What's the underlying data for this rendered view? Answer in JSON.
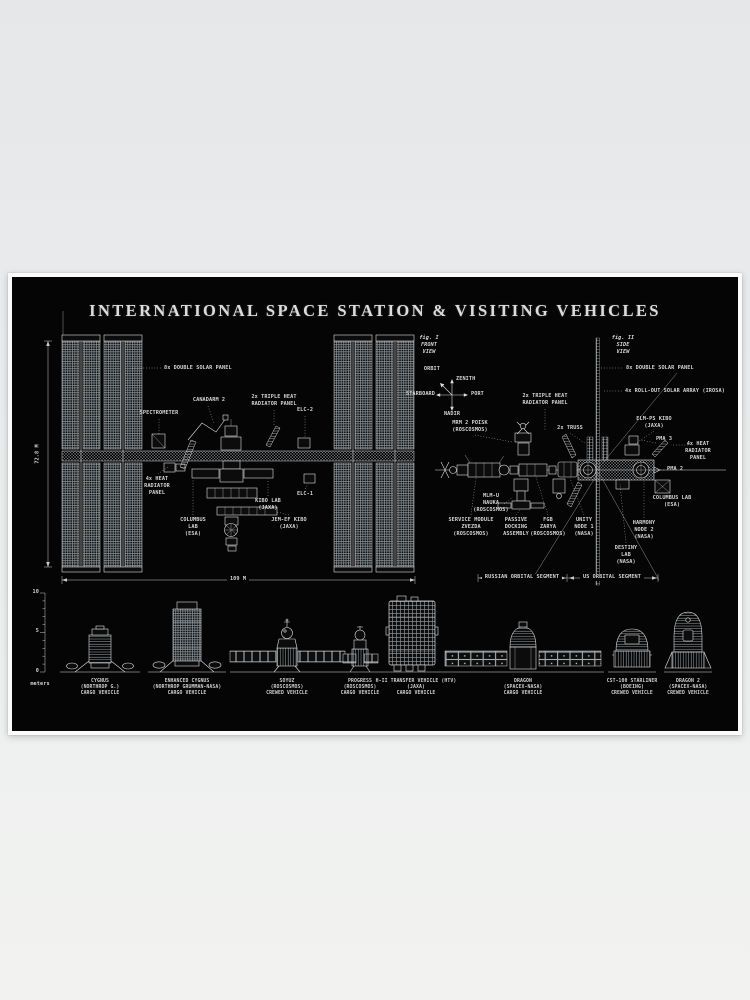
{
  "poster": {
    "title": "INTERNATIONAL SPACE STATION & VISITING VEHICLES",
    "front_view": {
      "fig_caption": "fig. I\nFRONT\nVIEW",
      "labels": {
        "double_solar": "8x DOUBLE SOLAR PANEL",
        "spectrometer": "SPECTROMETER",
        "canadarm": "CANADARM 2",
        "triple_radiator": "2x TRIPLE HEAT\nRADIATOR PANEL",
        "elc2": "ELC-2",
        "heat_radiator": "4x HEAT\nRADIATOR\nPANEL",
        "columbus": "COLUMBUS\nLAB\n(ESA)",
        "kibo": "KIBO LAB\n(JAXA)",
        "jem_ef": "JEM-EF KIBO\n(JAXA)",
        "elc1": "ELC-1"
      },
      "dim_height": "72.8 M",
      "dim_width": "109 M"
    },
    "compass": {
      "orbit": "ORBIT",
      "zenith": "ZENITH",
      "starboard": "STARBOARD",
      "port": "PORT",
      "nadir": "NADIR"
    },
    "side_view": {
      "fig_caption": "fig. II\nSIDE\nVIEW",
      "labels": {
        "double_solar": "8x DOUBLE SOLAR PANEL",
        "irosa": "4x ROLL-OUT SOLAR ARRAY (IROSA)",
        "triple_radiator": "2x TRIPLE HEAT\nRADIATOR PANEL",
        "mrm2": "MRM 2 POISK\n(ROSCOSMOS)",
        "truss": "2x TRUSS",
        "elm_ps": "ELM-PS KIBO\n(JAXA)",
        "pma3": "PMA 3",
        "heat_radiator": "4x HEAT\nRADIATOR\nPANEL",
        "pma2": "PMA 2",
        "columbus": "COLUMBUS LAB\n(ESA)",
        "mlm": "MLM-U\nNAUKA\n(ROSCOSMOS)",
        "zvezda": "SERVICE MODULE\nZVEZDA\n(ROSCOSMOS)",
        "docking": "PASSIVE\nDOCKING\nASSEMBLY",
        "zarya": "FGB\nZARYA\n(ROSCOSMOS)",
        "unity": "UNITY\nNODE 1\n(NASA)",
        "harmony": "HARMONY\nNODE 2\n(NASA)",
        "destiny": "DESTINY\nLAB\n(NASA)"
      },
      "segment_left": "RUSSIAN ORBITAL SEGMENT",
      "segment_right": "US ORBITAL SEGMENT"
    },
    "scale": {
      "ticks": [
        "10",
        "5",
        "0"
      ],
      "unit": "meters"
    },
    "vehicles": [
      {
        "label": "CYGNUS\n(NORTHROP G.)\nCARGO VEHICLE"
      },
      {
        "label": "ENHANCED CYGNUS\n(NORTHROP GRUMMAN-NASA)\nCARGO VEHICLE"
      },
      {
        "label": "SOYUZ\n(ROSCOSMOS)\nCREWED VEHICLE"
      },
      {
        "label": "PROGRESS\n(ROSCOSMOS)\nCARGO VEHICLE"
      },
      {
        "label": "H-II TRANSFER VEHICLE (HTV)\n(JAXA)\nCARGO VEHICLE"
      },
      {
        "label": "DRAGON\n(SPACEX-NASA)\nCARGO VEHICLE"
      },
      {
        "label": "CST-100 STARLINER\n(BOEING)\nCREWED VEHICLE"
      },
      {
        "label": "DRAGON 2\n(SPACEX-NASA)\nCREWED VEHICLE"
      }
    ],
    "colors": {
      "wall": "#e9ebec",
      "poster_bg": "#050505",
      "ink": "#dedede",
      "frame": "#fbfbfb"
    }
  }
}
